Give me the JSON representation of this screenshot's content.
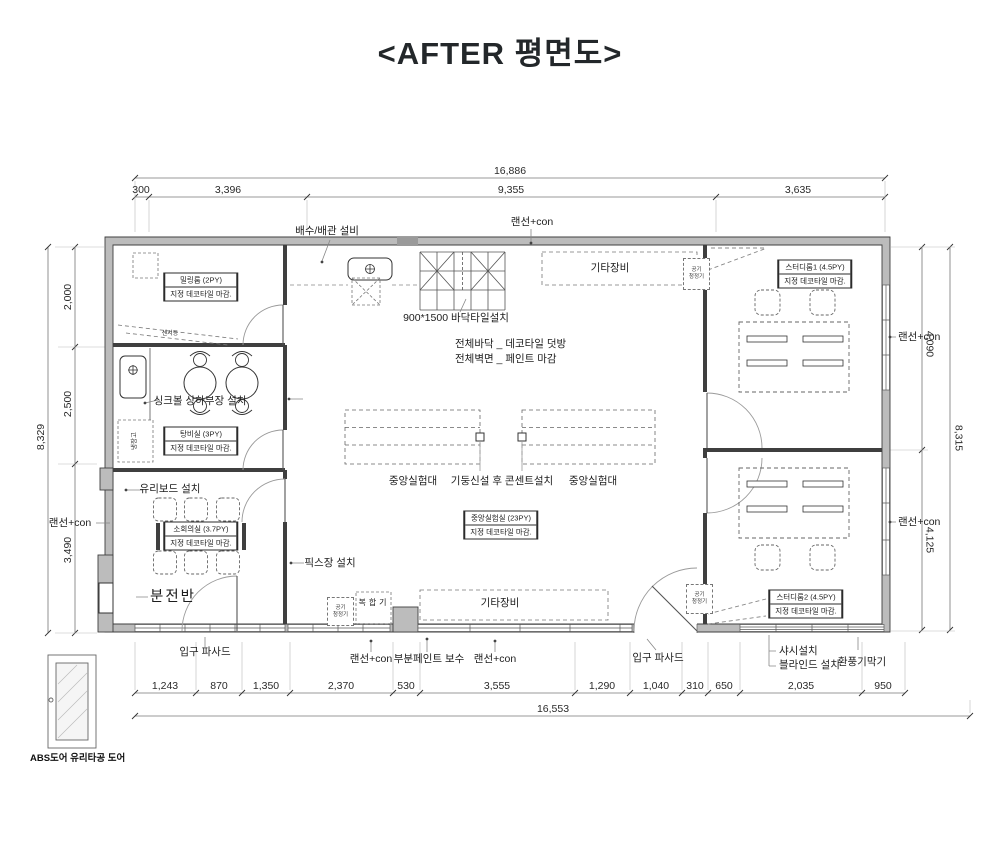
{
  "title": "<AFTER 평면도>",
  "dims": {
    "top_total": "16,886",
    "top": [
      "300",
      "3,396",
      "9,355",
      "3,635"
    ],
    "bottom": [
      "1,243",
      "870",
      "1,350",
      "2,370",
      "530",
      "3,555",
      "1,290",
      "1,040",
      "310",
      "650",
      "2,035",
      "950"
    ],
    "bottom_total": "16,553",
    "left": [
      "2,000",
      "2,500",
      "3,490"
    ],
    "left_total": "8,329",
    "right": [
      "4,090",
      "4,125"
    ],
    "right_total": "8,315"
  },
  "rooms": {
    "milling": {
      "name": "밀링룸 (2PY)",
      "finish": "지정 데코타일 마감."
    },
    "pantry": {
      "name": "탕비실 (3PY)",
      "finish": "지정 데코타일 마감."
    },
    "meeting": {
      "name": "소회의실 (3.7PY)",
      "finish": "지정 데코타일 마감."
    },
    "lab": {
      "name": "중앙실험실 (23PY)",
      "finish": "지정 데코타일 마감."
    },
    "study1": {
      "name": "스터디룸1 (4.5PY)",
      "finish": "지정 데코타일 마감."
    },
    "study2": {
      "name": "스터디룸2 (4.5PY)",
      "finish": "지정 데코타일 마감."
    }
  },
  "labels": {
    "drain": "배수/배관 설비",
    "lan_con": "랜선+con",
    "etc_equip": "기타장비",
    "air_purifier_1": "공기",
    "air_purifier_2": "청정기",
    "floor_tile": "900*1500 바닥타일설치",
    "floor_all": "전체바닥 _ 데코타일 덧방",
    "wall_all": "전체벽면 _ 페인트 마감",
    "sink": "싱크볼 상하부장 설치",
    "fridge": "냉장고",
    "sensor": "센서등",
    "bench": "중앙실험대",
    "column": "기둥신설 후 콘센트설치",
    "glassboard": "유리보드 설치",
    "fix": "픽스장 설치",
    "panel": "분전반",
    "copier": "복합기",
    "facade": "입구 파사드",
    "paint_repair": "부분페인트 보수",
    "sash": "샤시설치",
    "blind": "블라인드 설치",
    "vent": "환풍기막기",
    "abs_door": "ABS도어 유리타공 도어"
  },
  "colors": {
    "wall": "#bcbcbc",
    "line": "#3f3f3f",
    "dash": "#888888",
    "text": "#1d1d1d"
  }
}
